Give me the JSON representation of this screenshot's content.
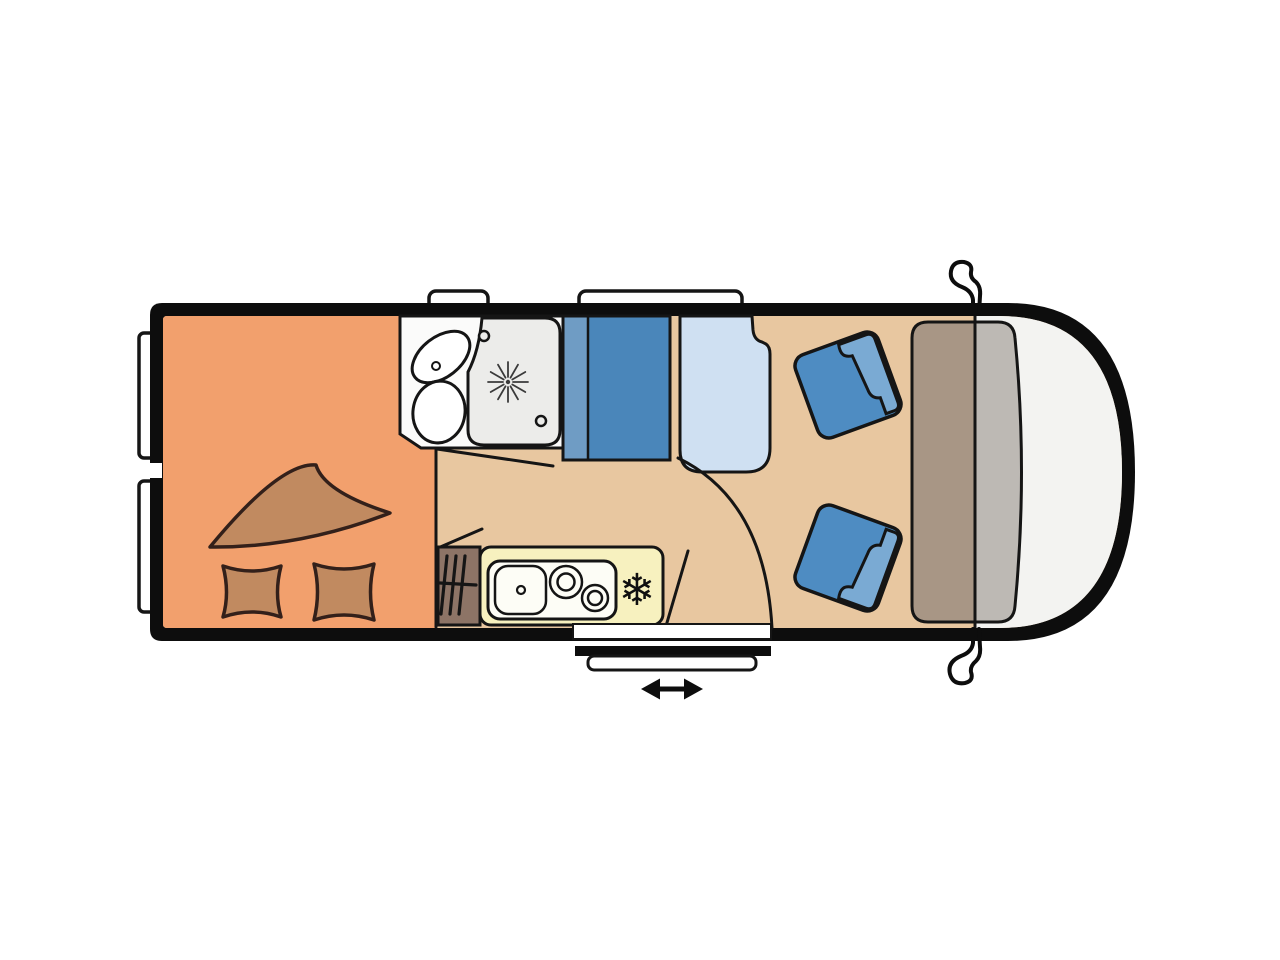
{
  "title": "campervan-floorplan-diagram",
  "icons": {
    "fridge_snowflake": "❄"
  },
  "palette": {
    "bg": "#ffffff",
    "body": "#0d0d0d",
    "outline": "#151515",
    "floor_bed": "#f2a06d",
    "bedding": "#c18a60",
    "bedding_outline": "#33201a",
    "floor_main": "#e8c7a0",
    "bathroom": "#fbfbfa",
    "shower_tray": "#ececea",
    "wardrobe_light": "#6f9cc4",
    "wardrobe_dark": "#4a86ba",
    "bench": "#cfe0f2",
    "seat": "#4e8cc2",
    "seat_back": "#7aaad3",
    "counter": "#f7f1bf",
    "counter_inset": "#fdfdf6",
    "heater": "#8d7466",
    "dashboard_left": "#a89685",
    "dashboard_right": "#bdb9b4",
    "cab_floor": "#f3f3f1",
    "window": "#ffffff"
  },
  "regions": {
    "bed": "rear bed with duvet and two pillows",
    "bathroom": "washroom with basin, toilet and shower tray",
    "wardrobe": "wardrobe cabinet",
    "bench": "side bench seat",
    "kitchen": "kitchen block with sink, two burners, fridge and heater",
    "cab": "driver cab with two swivel seats, dashboard and mirrors",
    "door": "sliding entry door with step"
  }
}
